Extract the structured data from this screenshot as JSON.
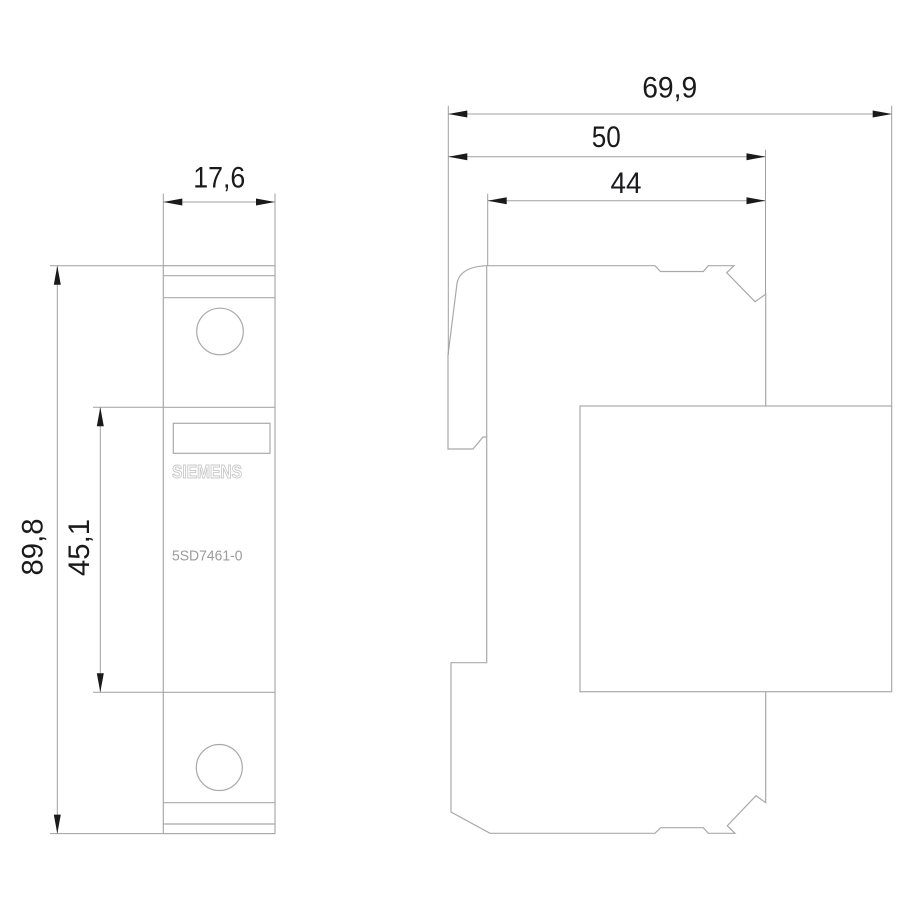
{
  "drawing": {
    "views": {
      "front": {
        "brand": "SIEMENS",
        "product_code": "5SD7461-0",
        "dim_width": "17,6",
        "dim_height": "89,8",
        "dim_rail_section": "45,1"
      },
      "side": {
        "dim_depth_total": "69,9",
        "dim_depth_body": "50",
        "dim_depth_front": "44"
      }
    },
    "colors": {
      "outline": "#a8a9ac",
      "dimension_line": "#9fa0a3",
      "arrow": "#1a1a1c",
      "dimension_text": "#1a1a1c",
      "brand_text": "#c9c9cb",
      "product_text": "#9c9c9f",
      "background": "#ffffff"
    }
  }
}
